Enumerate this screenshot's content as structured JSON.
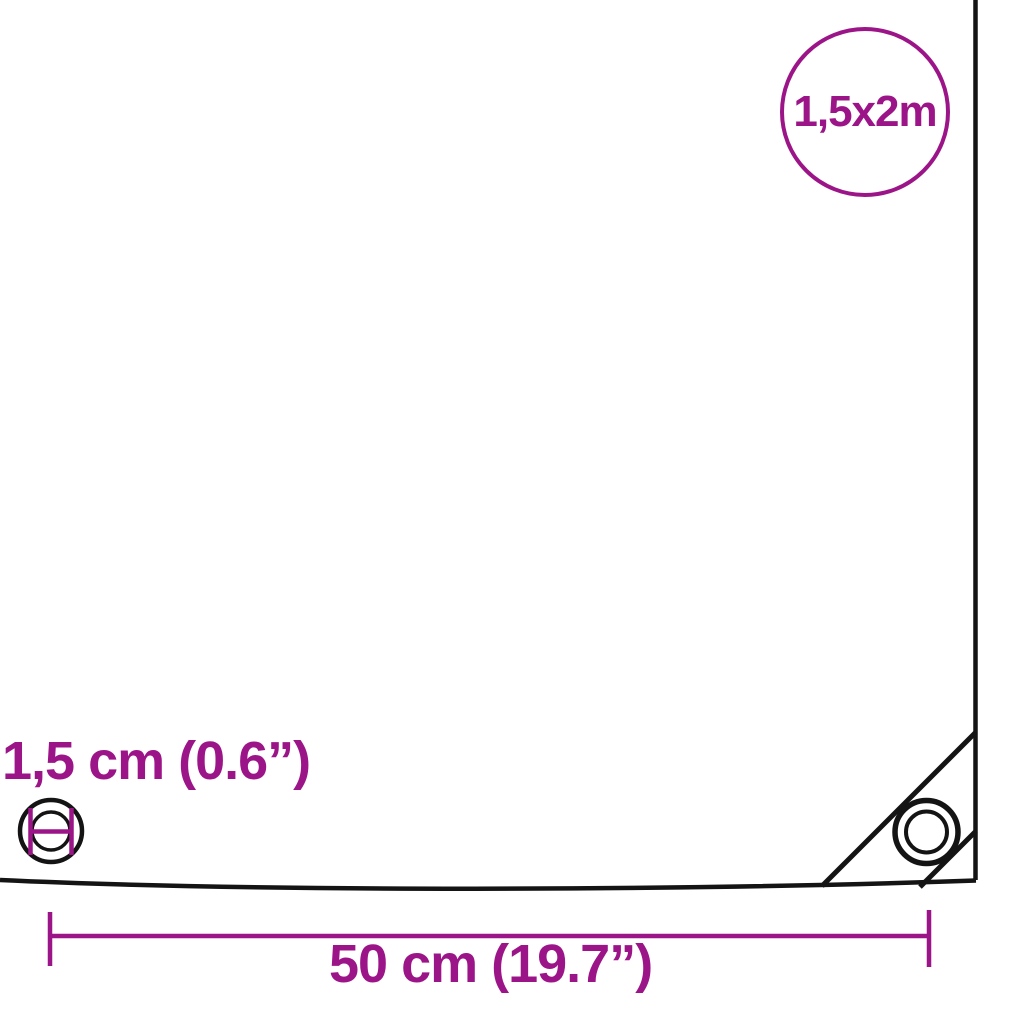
{
  "diagram": {
    "title": "tarpaulin-size-diagram",
    "size_badge": {
      "label": "1,5x2m"
    },
    "eyelet": {
      "label": "1,5 cm (0.6”)"
    },
    "width_dimension": {
      "label": "50 cm (19.7”)"
    },
    "colors": {
      "accent_purple": "#9C1588",
      "line_black": "#141414",
      "background": "#FFFFFF"
    },
    "icons": {
      "eyelet_measure_icon": "grommet ring with purple diameter measure marks",
      "corner_grommet_icon": "double-circle grommet in reinforced corner",
      "size_badge_circle": "purple circle outline badge"
    }
  }
}
